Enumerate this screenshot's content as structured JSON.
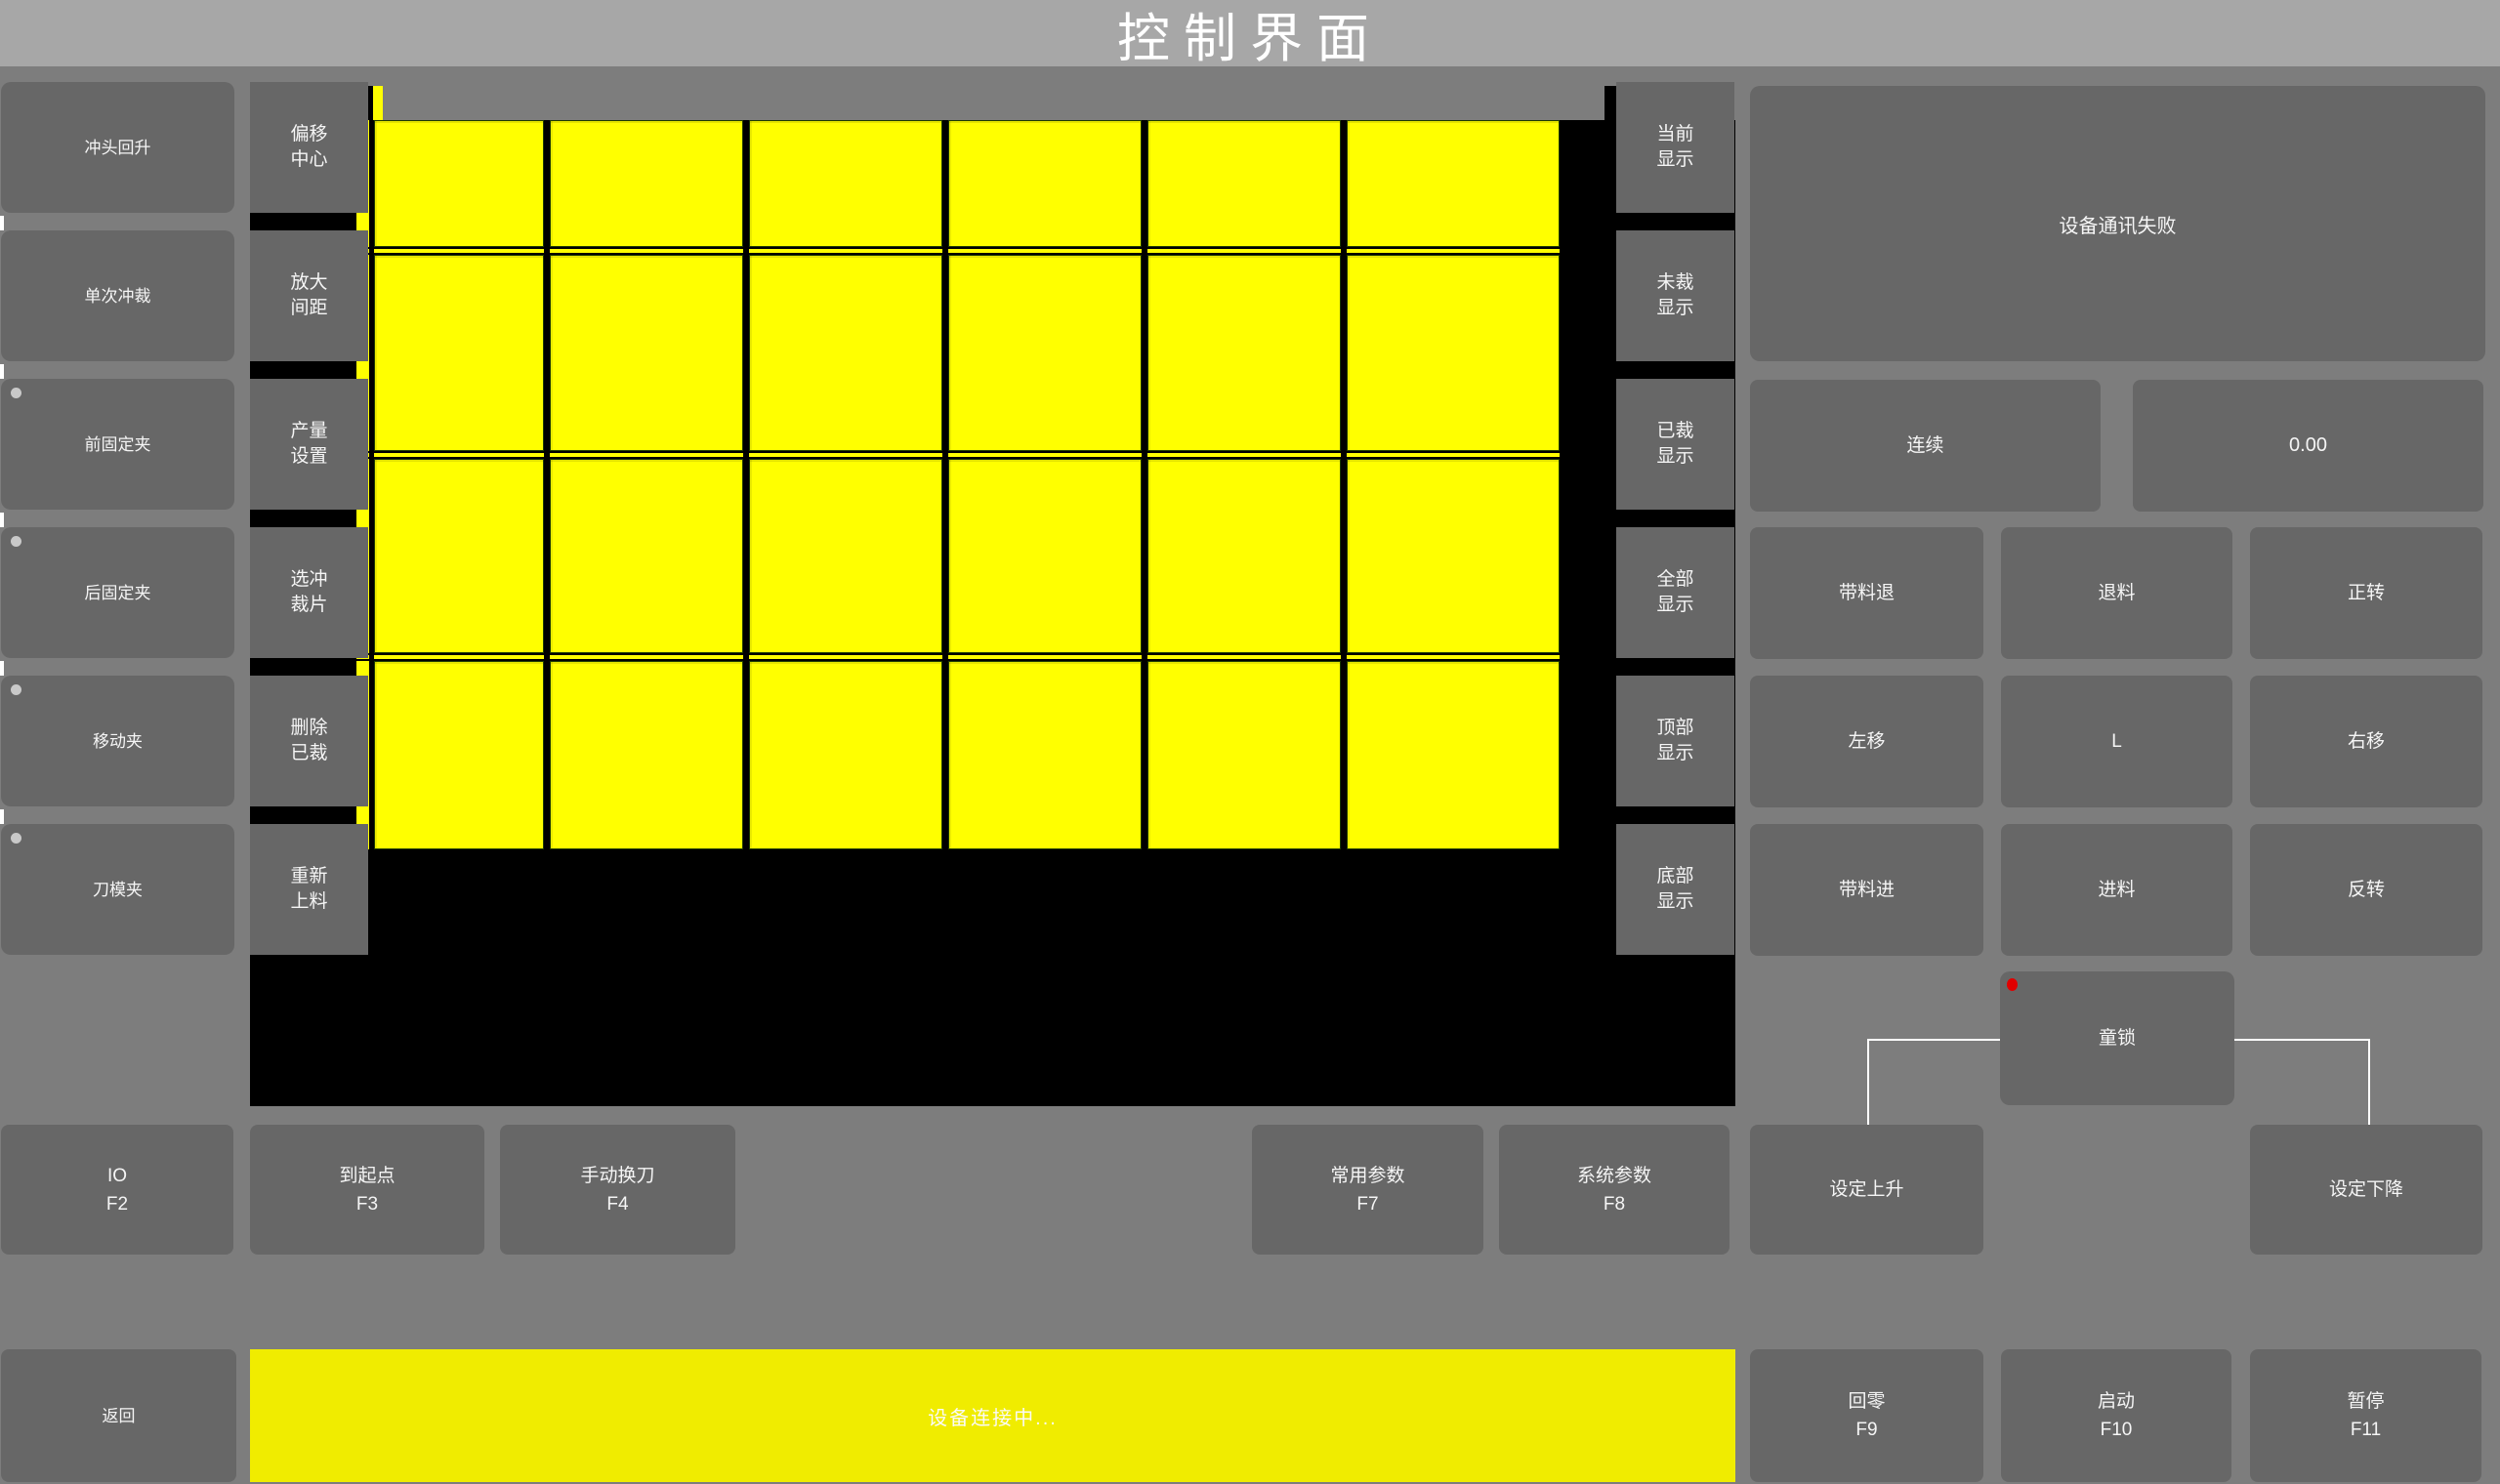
{
  "app": {
    "title": "控制界面"
  },
  "colors": {
    "background": "#7d7d7d",
    "titlebar": "#a7a7a7",
    "button_gray": "#676767",
    "button_text": "#f5f5f5",
    "canvas_black": "#000000",
    "piece_yellow": "#ffff00",
    "status_bar_yellow": "#f0ec00",
    "indicator_red": "#e10000",
    "indicator_gray": "#c9c9c9",
    "wire_white": "#ffffff"
  },
  "left_column": [
    {
      "label": "冲头回升",
      "indicator": false
    },
    {
      "label": "单次冲裁",
      "indicator": false
    },
    {
      "label": "前固定夹",
      "indicator": true
    },
    {
      "label": "后固定夹",
      "indicator": true
    },
    {
      "label": "移动夹",
      "indicator": true
    },
    {
      "label": "刀模夹",
      "indicator": true
    }
  ],
  "tool_column": [
    {
      "line1": "偏移",
      "line2": "中心"
    },
    {
      "line1": "放大",
      "line2": "间距"
    },
    {
      "line1": "产量",
      "line2": "设置"
    },
    {
      "line1": "选冲",
      "line2": "裁片"
    },
    {
      "line1": "删除",
      "line2": "已裁"
    },
    {
      "line1": "重新",
      "line2": "上料"
    }
  ],
  "display_column": [
    {
      "line1": "当前",
      "line2": "显示"
    },
    {
      "line1": "未裁",
      "line2": "显示"
    },
    {
      "line1": "已裁",
      "line2": "显示"
    },
    {
      "line1": "全部",
      "line2": "显示"
    },
    {
      "line1": "顶部",
      "line2": "显示"
    },
    {
      "line1": "底部",
      "line2": "显示"
    }
  ],
  "status_panel": {
    "message": "设备通讯失败"
  },
  "mode_button": {
    "label": "连续"
  },
  "value_display": {
    "value": "0.00"
  },
  "jog_pad": {
    "buttons": [
      "带料退",
      "退料",
      "正转",
      "左移",
      "L",
      "右移",
      "带料进",
      "进料",
      "反转"
    ]
  },
  "child_lock": {
    "label": "童锁"
  },
  "function_row": [
    {
      "label": "IO",
      "key": "F2"
    },
    {
      "label": "到起点",
      "key": "F3"
    },
    {
      "label": "手动换刀",
      "key": "F4"
    },
    {
      "label": "常用参数",
      "key": "F7"
    },
    {
      "label": "系统参数",
      "key": "F8"
    },
    {
      "label": "设定上升",
      "key": ""
    },
    {
      "label": "设定下降",
      "key": ""
    }
  ],
  "bottom_bar": {
    "back": "返回",
    "status": "设备连接中...",
    "keys": [
      {
        "label": "回零",
        "key": "F9"
      },
      {
        "label": "启动",
        "key": "F10"
      },
      {
        "label": "暂停",
        "key": "F11"
      }
    ]
  },
  "nest_grid": {
    "description": "yellow cutting-piece layout on black sheet view",
    "columns": 6,
    "rows": 4,
    "col_edges": [
      383,
      563,
      767,
      971,
      1175,
      1379,
      1597
    ],
    "col_gap": 6,
    "row_bands": [
      [
        123,
        253
      ],
      [
        261,
        462
      ],
      [
        470,
        669
      ],
      [
        677,
        870
      ]
    ],
    "spacer_bands": [
      [
        255,
        259
      ],
      [
        464,
        468
      ],
      [
        671,
        675
      ]
    ],
    "sliver_col": [
      365,
      378
    ]
  }
}
